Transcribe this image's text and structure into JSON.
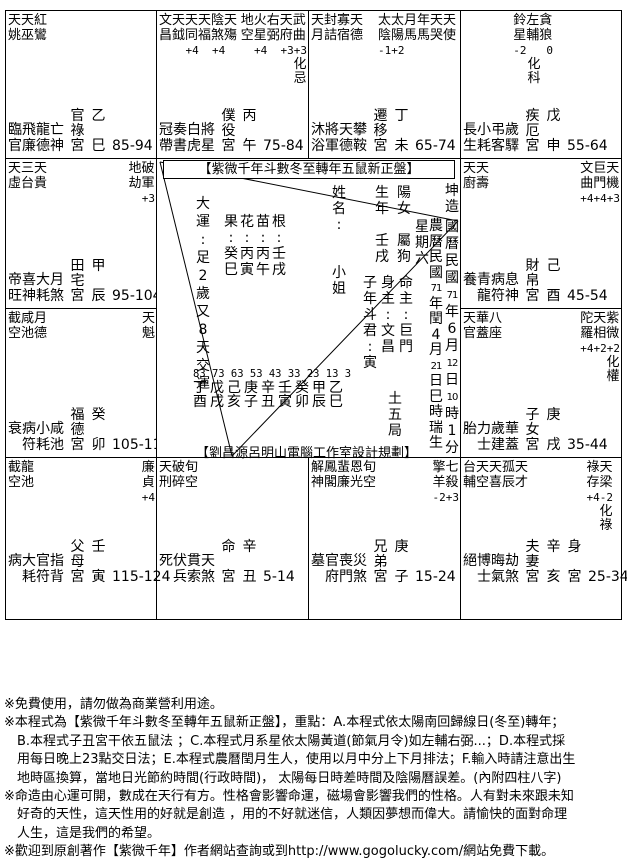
{
  "colors": {
    "ink": "#000000",
    "paper": "#ffffff"
  },
  "palaces": [
    {
      "id": "si",
      "row": 1,
      "col": 1,
      "palace": "官祿宮",
      "stem": "乙",
      "branch": "巳",
      "ages": "85-94",
      "body": false,
      "groups": [
        {
          "side": "left",
          "lines": [
            "天天紅",
            "姚巫鸞"
          ]
        }
      ],
      "cycle": [
        "臨飛龍亡",
        "官廉德神"
      ]
    },
    {
      "id": "wu",
      "row": 1,
      "col": 2,
      "palace": "僕役宮",
      "stem": "丙",
      "branch": "午",
      "ages": "75-84",
      "body": false,
      "groups": [
        {
          "side": "left",
          "lines": [
            "文天天天陰天",
            "昌鉞同福煞殤"
          ],
          "values": "    +4  +4"
        },
        {
          "side": "right",
          "lines": [
            "地火右天武",
            "空星弼府曲"
          ],
          "values": "  +4  +3+3",
          "hua": "忌"
        }
      ],
      "cycle": [
        "冠奏白將",
        "帶書虎星"
      ]
    },
    {
      "id": "wei",
      "row": 1,
      "col": 3,
      "palace": "遷移宮",
      "stem": "丁",
      "branch": "未",
      "ages": "65-74",
      "body": false,
      "groups": [
        {
          "side": "left",
          "lines": [
            "天封寡天",
            "月詰宿德"
          ]
        },
        {
          "side": "right",
          "lines": [
            "太太月年天天",
            "陰陽馬馬哭使"
          ],
          "values": "-1+2"
        }
      ],
      "cycle": [
        "沐將天攀",
        "浴軍德鞍"
      ]
    },
    {
      "id": "shen",
      "row": 1,
      "col": 4,
      "palace": "疾厄宮",
      "stem": "戊",
      "branch": "申",
      "ages": "55-64",
      "body": false,
      "groups": [
        {
          "side": "right",
          "lines": [
            "鈴左貪",
            "星輔狼"
          ],
          "values": "-2   0",
          "hua": "科"
        }
      ],
      "cycle": [
        "長小弔歲",
        "生耗客驛"
      ]
    },
    {
      "id": "you",
      "row": 2,
      "col": 4,
      "palace": "財帛宮",
      "stem": "己",
      "branch": "酉",
      "ages": "45-54",
      "body": false,
      "groups": [
        {
          "side": "left",
          "lines": [
            "天天",
            "廚壽"
          ]
        },
        {
          "side": "right",
          "lines": [
            "文巨天",
            "曲門機"
          ],
          "values": "+4+4+3"
        }
      ],
      "cycle": [
        "養青病息",
        "　龍符神"
      ]
    },
    {
      "id": "xu",
      "row": 3,
      "col": 4,
      "palace": "子女宮",
      "stem": "庚",
      "branch": "戌",
      "ages": "35-44",
      "body": false,
      "groups": [
        {
          "side": "left",
          "lines": [
            "天華八",
            "官蓋座"
          ]
        },
        {
          "side": "right",
          "lines": [
            "陀天紫",
            "羅相微"
          ],
          "values": "+4+2+2",
          "hua": "權"
        }
      ],
      "cycle": [
        "胎力歲華",
        "　士建蓋"
      ]
    },
    {
      "id": "hai",
      "row": 4,
      "col": 4,
      "palace": "夫妻宮",
      "stem": "辛",
      "branch": "亥",
      "ages": "25-34",
      "body": true,
      "groups": [
        {
          "side": "left",
          "lines": [
            "台天天孤天",
            "輔空喜辰才"
          ]
        },
        {
          "side": "right",
          "lines": [
            "祿天",
            "存梁"
          ],
          "values": "+4-2",
          "hua": "祿"
        }
      ],
      "cycle": [
        "絕博晦劫",
        "　士氣煞"
      ]
    },
    {
      "id": "zi",
      "row": 4,
      "col": 3,
      "palace": "兄弟宮",
      "stem": "庚",
      "branch": "子",
      "ages": "15-24",
      "body": false,
      "groups": [
        {
          "side": "left",
          "lines": [
            "解鳳蜚恩旬",
            "神閣廉光空"
          ]
        },
        {
          "side": "right",
          "lines": [
            "擎七",
            "羊殺"
          ],
          "values": "-2+3"
        }
      ],
      "cycle": [
        "墓官喪災",
        "　府門煞"
      ]
    },
    {
      "id": "chou",
      "row": 4,
      "col": 2,
      "palace": "命宮",
      "stem": "辛",
      "branch": "丑",
      "ages": "5-14",
      "body": false,
      "groups": [
        {
          "side": "left",
          "lines": [
            "天破旬",
            "刑碎空"
          ]
        }
      ],
      "cycle": [
        "死伏貫天",
        "　兵索煞"
      ]
    },
    {
      "id": "yin",
      "row": 4,
      "col": 1,
      "palace": "父母宮",
      "stem": "壬",
      "branch": "寅",
      "ages": "115-124",
      "body": false,
      "groups": [
        {
          "side": "left",
          "lines": [
            "截龍",
            "空池"
          ]
        },
        {
          "side": "right",
          "lines": [
            "廉",
            "貞"
          ],
          "values": "+4"
        }
      ],
      "cycle": [
        "病大官指",
        "　耗符背"
      ]
    },
    {
      "id": "mao",
      "row": 3,
      "col": 1,
      "palace": "福德宮",
      "stem": "癸",
      "branch": "卯",
      "ages": "105-114",
      "body": false,
      "groups": [
        {
          "side": "left",
          "lines": [
            "截咸月",
            "空池德"
          ]
        },
        {
          "side": "right",
          "lines": [
            "天",
            "魁"
          ]
        }
      ],
      "cycle": [
        "衰病小咸",
        "　符耗池"
      ]
    },
    {
      "id": "chen",
      "row": 2,
      "col": 1,
      "palace": "田宅宮",
      "stem": "甲",
      "branch": "辰",
      "ages": "95-104",
      "body": false,
      "groups": [
        {
          "side": "left",
          "lines": [
            "天三天",
            "虛台貴"
          ]
        },
        {
          "side": "right",
          "lines": [
            "地破",
            "劫軍"
          ],
          "values": "  +3"
        }
      ],
      "cycle": [
        "帝喜大月",
        "旺神耗煞"
      ]
    }
  ],
  "center": {
    "title": "【紫微千年斗數冬至轉年五鼠新正盤】",
    "columns": {
      "dayun": [
        "大",
        "運",
        ":",
        "足",
        "2",
        "歲",
        "又",
        "8",
        "天",
        "交",
        "運"
      ],
      "pillar_guo": [
        "果",
        ":",
        "癸",
        "巳"
      ],
      "pillar_hua": [
        "花",
        ":",
        "丙",
        "寅"
      ],
      "pillar_miao": [
        "苗",
        ":",
        "丙",
        "午"
      ],
      "pillar_gen": [
        "根",
        ":",
        "壬",
        "戌"
      ],
      "name": [
        "姓",
        "名",
        ":",
        "",
        "",
        "小",
        "姐"
      ],
      "birth_year": [
        "生",
        "年",
        "",
        "壬",
        "戌"
      ],
      "gender": [
        "陽",
        "女",
        "",
        "屬",
        "狗"
      ],
      "weekday": [
        "星",
        "期",
        "六"
      ],
      "lunar": [
        "農",
        "曆",
        "民",
        "國",
        "71",
        "年",
        "閏",
        "4",
        "月",
        "21",
        "日",
        "巳",
        "時",
        "瑞",
        "生"
      ],
      "kun": [
        "坤",
        "造"
      ],
      "solar": [
        "國",
        "曆",
        "民",
        "國",
        "71",
        "年",
        "6",
        "月",
        "12",
        "日",
        "10",
        "時",
        "1",
        "分"
      ],
      "doujun": [
        "子",
        "年",
        "斗",
        "君",
        ":",
        "寅"
      ],
      "body_lord": [
        "身",
        "主",
        ":",
        "文",
        "昌"
      ],
      "life_lord": [
        "命",
        "主",
        ":",
        "巨",
        "門"
      ],
      "bureau": [
        "土",
        "五",
        "局"
      ]
    },
    "daxian": {
      "numbers": "83 73 63 53 43 33 23 13 3",
      "stems": "丁戊己庚辛壬癸甲乙",
      "branches": "酉戌亥子丑寅卯辰巳"
    },
    "credit": "【劉昌源呂明山電腦工作室設計規劃】"
  },
  "footer_lines": [
    "※免費使用，請勿做為商業營利用途。",
    "※本程式為【紫微千年斗數冬至轉年五鼠新正盤】，重點：A.本程式依太陽南回歸線日(冬至)轉年；",
    "　B.本程式子丑宮干依五鼠法 ；C.本程式月系星依太陽黃道(節氣月令)如左輔右弼...；D.本程式採",
    "　用每日晚上23點交日法；E.本程式農曆閏月生人，使用以月中分上下月排法；F.輸入時請注意出生",
    "　地時區換算，當地日光節約時間(行政時間)， 太陽每日時差時間及陰陽曆誤差。(內附四柱八字)",
    "※命造由心運可開，數成在天行有方。性格會影響命運，磁場會影響我們的性格。人有對未來跟未知",
    "　好奇的天性，這天性用的好就是創造 ，用的不好就迷信，人類因夢想而偉大。請愉快的面對命理",
    "　人生，這是我們的希望。",
    "※歡迎到原創著作【紫微千年】作者網站查詢或到http://www.gogolucky.com/網站免費下載。"
  ]
}
